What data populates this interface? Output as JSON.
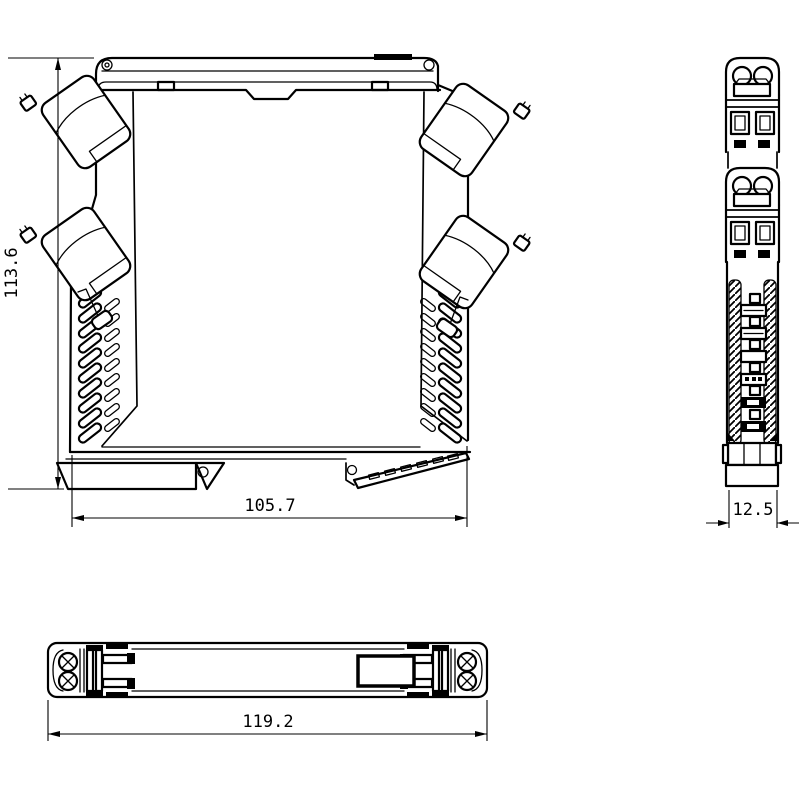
{
  "colors": {
    "background": "#ffffff",
    "line": "#000000"
  },
  "dimensions": {
    "front_height": {
      "value": "113.6"
    },
    "front_width": {
      "value": "105.7"
    },
    "side_width": {
      "value": "12.5"
    },
    "bottom_length": {
      "value": "119.2"
    }
  }
}
